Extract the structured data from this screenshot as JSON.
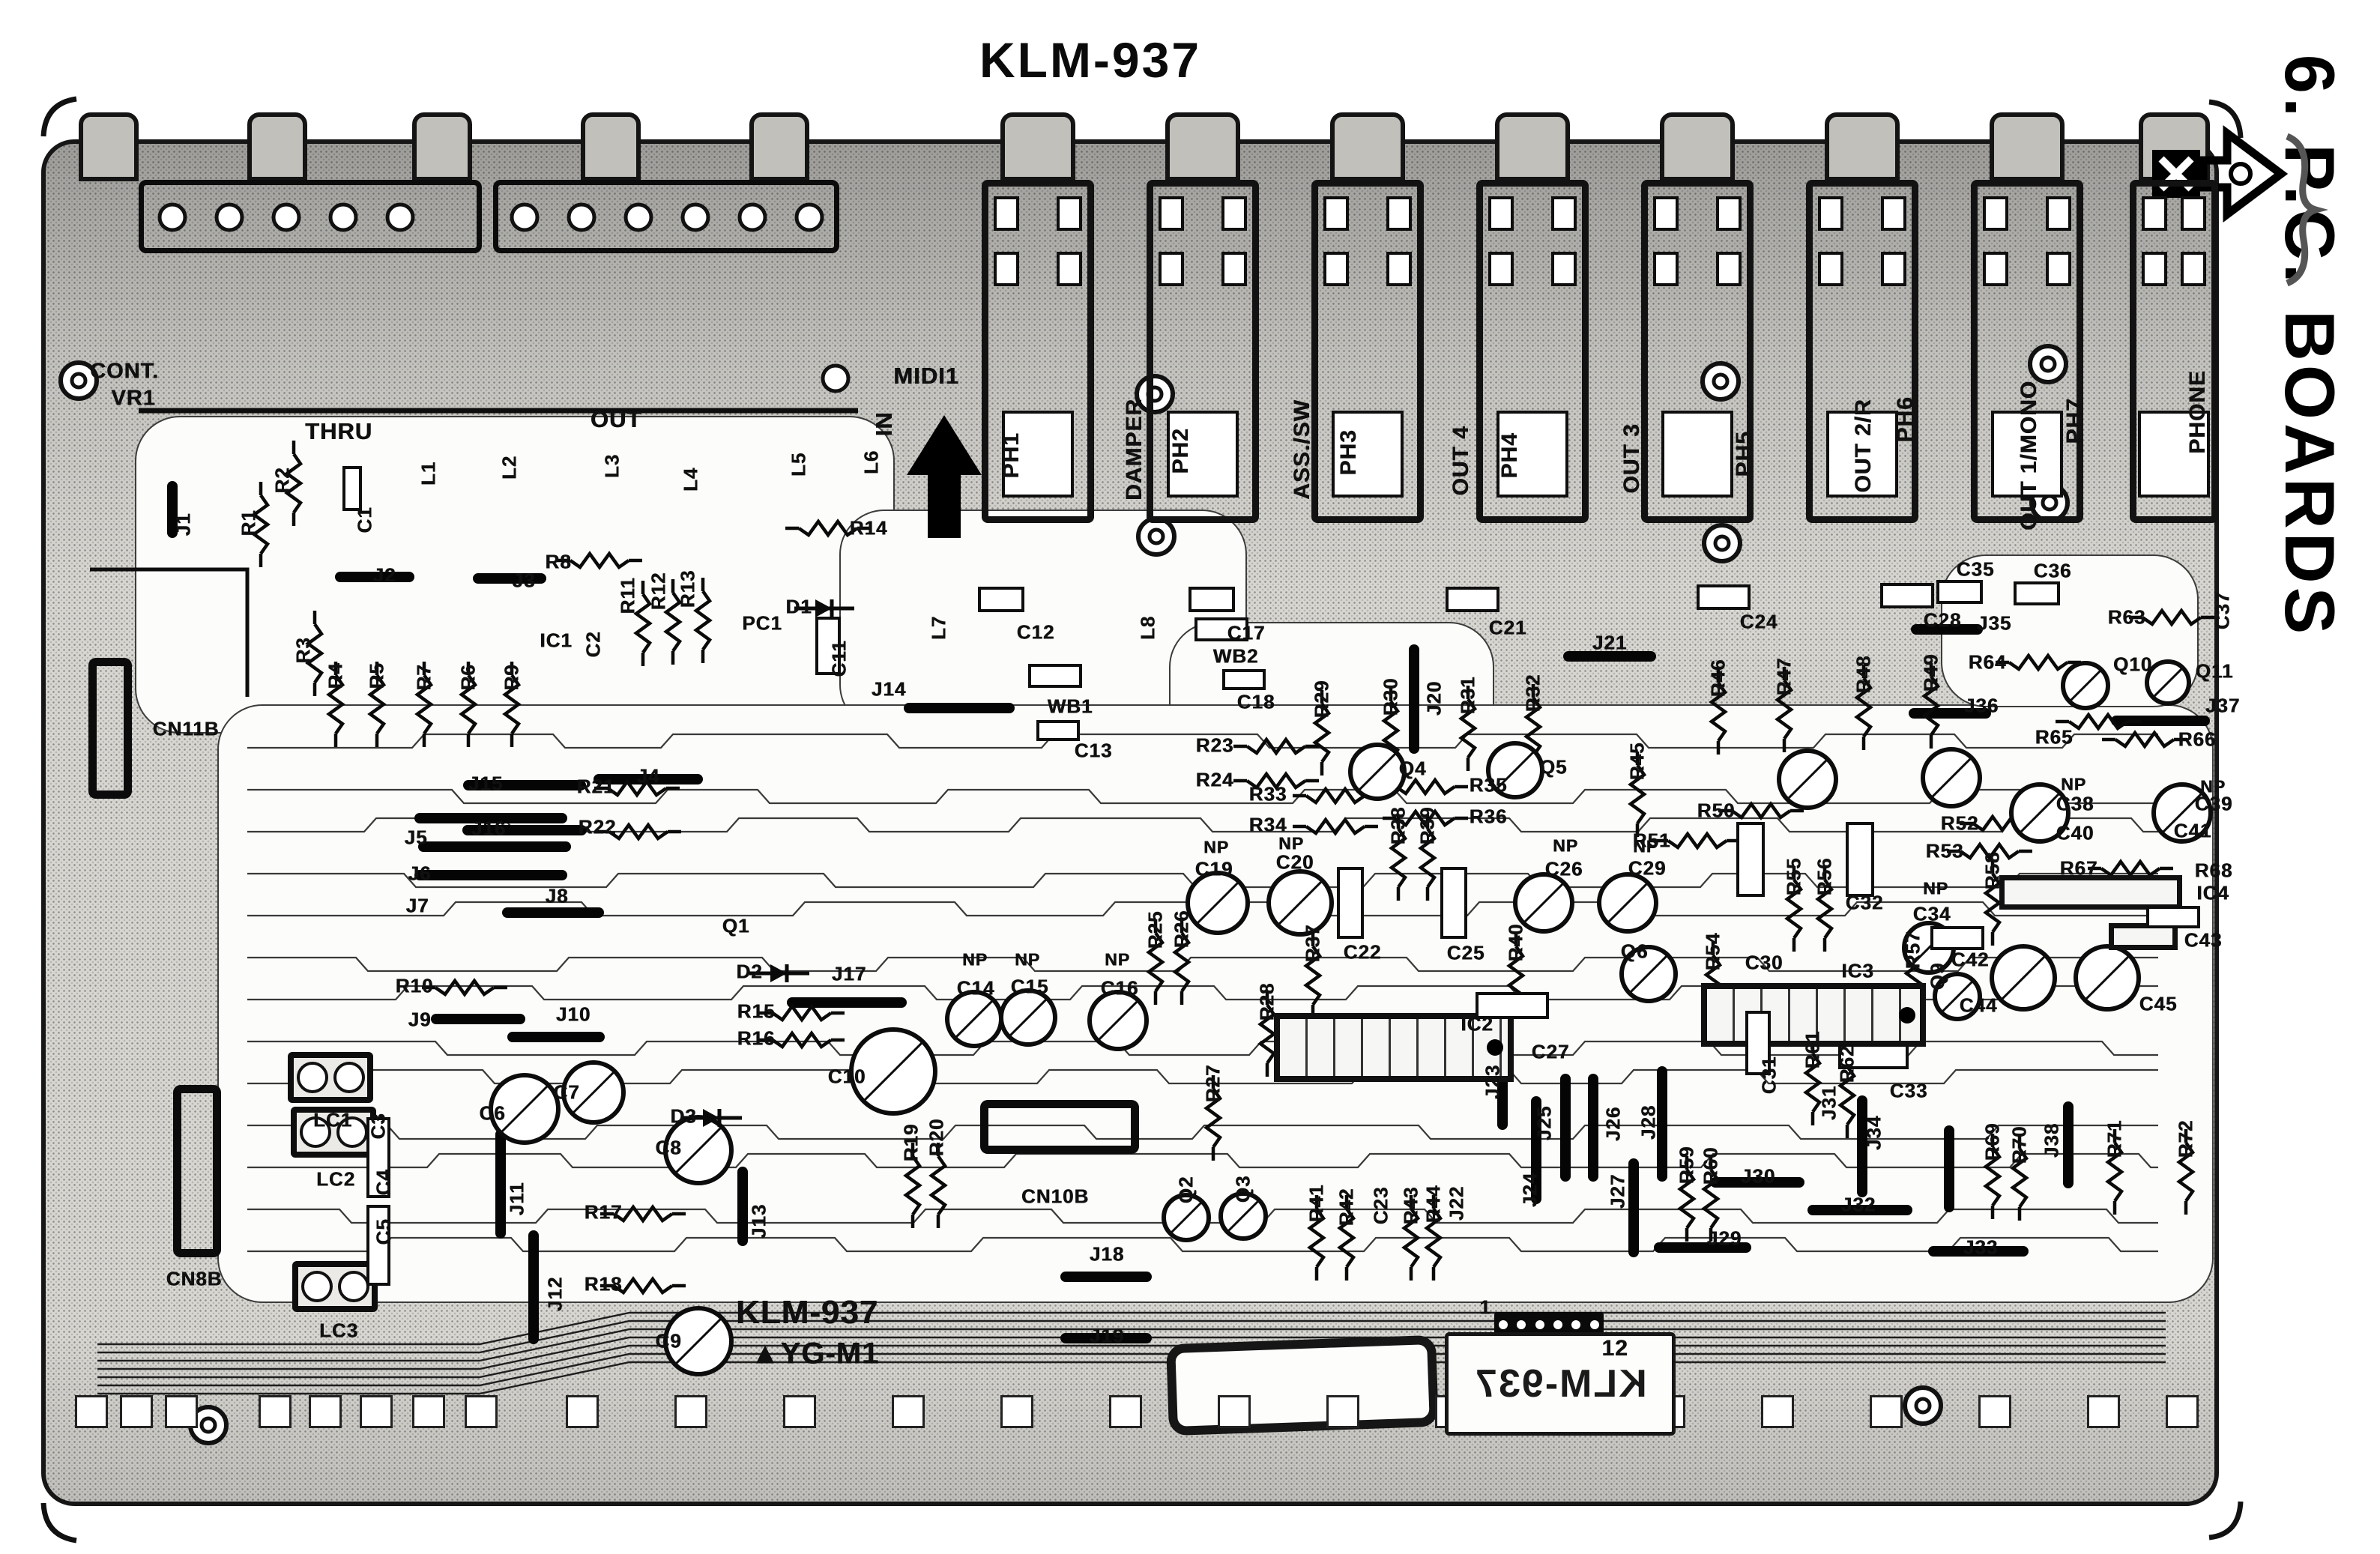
{
  "page": {
    "title": "KLM-937",
    "section": "6. P.C. BOARDS"
  },
  "board": {
    "name": "KLM-937",
    "silk_title": "KLM-937",
    "silk_marking": "YG-M1",
    "silk_title_mirrored": "KLM-937",
    "connector_pin_first": "1",
    "connector_pin_last": "12",
    "labels": [
      [
        "CONT.",
        166,
        496,
        0,
        29
      ],
      [
        "VR1",
        178,
        532,
        0,
        29
      ],
      [
        "THRU",
        452,
        576,
        0,
        31
      ],
      [
        "OUT",
        822,
        560,
        0,
        31
      ],
      [
        "MIDI1",
        1236,
        502,
        0,
        31
      ],
      [
        "IN",
        1180,
        566,
        1,
        31
      ],
      [
        "L1",
        572,
        632,
        1
      ],
      [
        "L2",
        680,
        624,
        1
      ],
      [
        "L3",
        817,
        622,
        1
      ],
      [
        "L4",
        922,
        640,
        1
      ],
      [
        "L5",
        1066,
        620,
        1
      ],
      [
        "L6",
        1163,
        617,
        1
      ],
      [
        "L7",
        1253,
        838,
        1
      ],
      [
        "L8",
        1532,
        838,
        1
      ],
      [
        "J1",
        245,
        700,
        1
      ],
      [
        "R1",
        332,
        698,
        1
      ],
      [
        "R2",
        377,
        641,
        1
      ],
      [
        "C1",
        487,
        694,
        1
      ],
      [
        "R3",
        405,
        868,
        1
      ],
      [
        "J2",
        513,
        768,
        0
      ],
      [
        "J3",
        699,
        775,
        0
      ],
      [
        "R8",
        745,
        750,
        0
      ],
      [
        "R11",
        838,
        795,
        1
      ],
      [
        "R12",
        879,
        789,
        1
      ],
      [
        "R13",
        918,
        786,
        1
      ],
      [
        "IC1",
        742,
        855,
        0
      ],
      [
        "C2",
        792,
        860,
        1
      ],
      [
        "PC1",
        1017,
        832,
        0
      ],
      [
        "D1",
        1066,
        810,
        0
      ],
      [
        "R14",
        1159,
        705,
        0
      ],
      [
        "C11",
        1120,
        879,
        1
      ],
      [
        "J14",
        1186,
        920,
        0
      ],
      [
        "R4",
        448,
        902,
        1
      ],
      [
        "R5",
        503,
        902,
        1
      ],
      [
        "R7",
        566,
        904,
        1
      ],
      [
        "R6",
        625,
        904,
        1
      ],
      [
        "R9",
        683,
        904,
        1
      ],
      [
        "J4",
        865,
        1036,
        0
      ],
      [
        "J15",
        648,
        1046,
        0
      ],
      [
        "R21",
        795,
        1050,
        0
      ],
      [
        "J16",
        652,
        1106,
        0
      ],
      [
        "R22",
        797,
        1104,
        0
      ],
      [
        "C12",
        1382,
        844,
        0
      ],
      [
        "WB1",
        1428,
        943,
        0
      ],
      [
        "C13",
        1459,
        1002,
        0
      ],
      [
        "WB2",
        1649,
        876,
        0
      ],
      [
        "C18",
        1676,
        937,
        0
      ],
      [
        "C17",
        1663,
        845,
        0
      ],
      [
        "R23",
        1621,
        995,
        0
      ],
      [
        "R24",
        1621,
        1041,
        0
      ],
      [
        "PH1",
        1350,
        608,
        1,
        30
      ],
      [
        "DAMPER",
        1514,
        600,
        1,
        30
      ],
      [
        "PH2",
        1576,
        602,
        1,
        30
      ],
      [
        "ASS./SW",
        1738,
        600,
        1,
        30
      ],
      [
        "PH3",
        1800,
        604,
        1,
        30
      ],
      [
        "OUT 4",
        1950,
        615,
        1,
        30
      ],
      [
        "PH4",
        2015,
        608,
        1,
        30
      ],
      [
        "OUT 3",
        2178,
        612,
        1,
        30
      ],
      [
        "PH5",
        2328,
        606,
        1,
        30
      ],
      [
        "OUT 2/R",
        2487,
        595,
        1,
        30
      ],
      [
        "PH6",
        2543,
        560,
        1,
        30
      ],
      [
        "OUT 1/MONO",
        2708,
        608,
        1,
        30
      ],
      [
        "PH7",
        2769,
        562,
        1,
        30
      ],
      [
        "PHONE",
        2933,
        550,
        1,
        30
      ],
      [
        "C37",
        2966,
        815,
        1
      ],
      [
        "C21",
        2012,
        838,
        0
      ],
      [
        "J21",
        2148,
        858,
        0
      ],
      [
        "C24",
        2347,
        830,
        0
      ],
      [
        "C28",
        2592,
        828,
        0
      ],
      [
        "C35",
        2636,
        760,
        0
      ],
      [
        "C36",
        2739,
        762,
        0
      ],
      [
        "J35",
        2661,
        832,
        0
      ],
      [
        "R63",
        2838,
        824,
        0
      ],
      [
        "R64",
        2652,
        884,
        0
      ],
      [
        "Q10",
        2846,
        887,
        0
      ],
      [
        "Q11",
        2955,
        896,
        0
      ],
      [
        "J36",
        2644,
        942,
        0
      ],
      [
        "J37",
        2966,
        942,
        0
      ],
      [
        "R65",
        2741,
        984,
        0
      ],
      [
        "R66",
        2932,
        987,
        0
      ],
      [
        "R29",
        1764,
        933,
        1
      ],
      [
        "R30",
        1856,
        930,
        1
      ],
      [
        "J20",
        1914,
        932,
        1
      ],
      [
        "R31",
        1959,
        928,
        1
      ],
      [
        "R32",
        2046,
        925,
        1
      ],
      [
        "Q4",
        1885,
        1026,
        0
      ],
      [
        "Q5",
        2073,
        1024,
        0
      ],
      [
        "R45",
        2185,
        1016,
        1
      ],
      [
        "R46",
        2293,
        905,
        1
      ],
      [
        "R47",
        2381,
        903,
        1
      ],
      [
        "R48",
        2487,
        900,
        1
      ],
      [
        "R49",
        2577,
        898,
        1
      ],
      [
        "R33",
        1692,
        1060,
        0
      ],
      [
        "R34",
        1692,
        1101,
        0
      ],
      [
        "R35",
        1986,
        1048,
        0
      ],
      [
        "R36",
        1986,
        1090,
        0
      ],
      [
        "R38",
        1866,
        1102,
        1
      ],
      [
        "R39",
        1905,
        1102,
        1
      ],
      [
        "NP",
        1623,
        1131,
        0,
        23
      ],
      [
        "C19",
        1620,
        1160,
        0
      ],
      [
        "NP",
        1723,
        1126,
        0,
        23
      ],
      [
        "C20",
        1728,
        1151,
        0
      ],
      [
        "R37",
        1752,
        1259,
        1
      ],
      [
        "C22",
        1818,
        1271,
        0
      ],
      [
        "C25",
        1956,
        1272,
        0
      ],
      [
        "R40",
        2023,
        1258,
        1
      ],
      [
        "R25",
        1542,
        1241,
        1
      ],
      [
        "R26",
        1577,
        1240,
        1
      ],
      [
        "R27",
        1619,
        1446,
        1
      ],
      [
        "R28",
        1691,
        1337,
        1
      ],
      [
        "IC2",
        1971,
        1367,
        0
      ],
      [
        "J23",
        1992,
        1444,
        1
      ],
      [
        "C27",
        2069,
        1404,
        0
      ],
      [
        "NP",
        2089,
        1129,
        0,
        23
      ],
      [
        "C26",
        2087,
        1160,
        0
      ],
      [
        "NP",
        2196,
        1130,
        0,
        23
      ],
      [
        "C29",
        2198,
        1159,
        0
      ],
      [
        "Q6",
        2181,
        1270,
        0
      ],
      [
        "R54",
        2286,
        1270,
        1
      ],
      [
        "C30",
        2354,
        1285,
        0
      ],
      [
        "IC3",
        2479,
        1296,
        0
      ],
      [
        "R57",
        2553,
        1268,
        1
      ],
      [
        "Q9",
        2586,
        1303,
        1
      ],
      [
        "C42",
        2629,
        1281,
        0
      ],
      [
        "R50",
        2290,
        1082,
        0
      ],
      [
        "R51",
        2204,
        1122,
        0
      ],
      [
        "R55",
        2394,
        1170,
        1
      ],
      [
        "R56",
        2435,
        1170,
        1
      ],
      [
        "C32",
        2488,
        1205,
        0
      ],
      [
        "NP",
        2583,
        1186,
        0,
        23
      ],
      [
        "C34",
        2578,
        1220,
        0
      ],
      [
        "R52",
        2615,
        1099,
        0
      ],
      [
        "R53",
        2595,
        1136,
        0
      ],
      [
        "R58",
        2659,
        1162,
        1
      ],
      [
        "NP",
        2767,
        1047,
        0,
        23
      ],
      [
        "C38",
        2769,
        1073,
        0
      ],
      [
        "NP",
        2953,
        1050,
        0,
        23
      ],
      [
        "C39",
        2954,
        1073,
        0
      ],
      [
        "C40",
        2769,
        1112,
        0
      ],
      [
        "C41",
        2926,
        1109,
        0
      ],
      [
        "R67",
        2774,
        1159,
        0
      ],
      [
        "R68",
        2954,
        1162,
        0
      ],
      [
        "IC4",
        2953,
        1192,
        0
      ],
      [
        "C43",
        2940,
        1255,
        0
      ],
      [
        "C44",
        2640,
        1342,
        0
      ],
      [
        "C45",
        2880,
        1340,
        0
      ],
      [
        "CN11B",
        248,
        973,
        0
      ],
      [
        "J5",
        555,
        1118,
        0
      ],
      [
        "J6",
        560,
        1166,
        0
      ],
      [
        "J7",
        557,
        1209,
        0
      ],
      [
        "J8",
        743,
        1196,
        0
      ],
      [
        "R10",
        553,
        1316,
        0
      ],
      [
        "J9",
        560,
        1361,
        0
      ],
      [
        "J10",
        765,
        1354,
        0
      ],
      [
        "Q1",
        982,
        1236,
        0
      ],
      [
        "D2",
        1000,
        1297,
        0
      ],
      [
        "J17",
        1133,
        1300,
        0
      ],
      [
        "R15",
        1009,
        1350,
        0
      ],
      [
        "R16",
        1009,
        1386,
        0
      ],
      [
        "C7",
        756,
        1458,
        0
      ],
      [
        "D3",
        912,
        1490,
        0
      ],
      [
        "C10",
        1130,
        1437,
        0
      ],
      [
        "C6",
        657,
        1486,
        0
      ],
      [
        "LC1",
        444,
        1495,
        0
      ],
      [
        "C3",
        505,
        1503,
        1
      ],
      [
        "C8",
        892,
        1532,
        0
      ],
      [
        "R17",
        805,
        1618,
        0
      ],
      [
        "R18",
        805,
        1714,
        0
      ],
      [
        "C9",
        892,
        1790,
        0
      ],
      [
        "J11",
        690,
        1600,
        1
      ],
      [
        "J13",
        1013,
        1630,
        1
      ],
      [
        "R19",
        1216,
        1525,
        1
      ],
      [
        "R20",
        1250,
        1518,
        1
      ],
      [
        "LC2",
        448,
        1574,
        0
      ],
      [
        "C4",
        512,
        1578,
        1
      ],
      [
        "C5",
        512,
        1644,
        1
      ],
      [
        "CN8B",
        259,
        1707,
        0
      ],
      [
        "LC3",
        452,
        1776,
        0
      ],
      [
        "J12",
        741,
        1727,
        1
      ],
      [
        "NP",
        1301,
        1281,
        0,
        23
      ],
      [
        "C14",
        1302,
        1319,
        0
      ],
      [
        "NP",
        1371,
        1281,
        0,
        23
      ],
      [
        "C15",
        1374,
        1317,
        0
      ],
      [
        "NP",
        1491,
        1281,
        0,
        23
      ],
      [
        "C16",
        1494,
        1319,
        0
      ],
      [
        "CN10B",
        1408,
        1597,
        0
      ],
      [
        "Q2",
        1583,
        1588,
        1
      ],
      [
        "Q3",
        1659,
        1587,
        1
      ],
      [
        "J18",
        1477,
        1674,
        0
      ],
      [
        "J19",
        1477,
        1783,
        0
      ],
      [
        "R41",
        1757,
        1606,
        1
      ],
      [
        "R42",
        1797,
        1611,
        1
      ],
      [
        "C23",
        1843,
        1609,
        1
      ],
      [
        "R43",
        1883,
        1609,
        1
      ],
      [
        "R44",
        1913,
        1607,
        1
      ],
      [
        "J22",
        1944,
        1606,
        1
      ],
      [
        "J24",
        2042,
        1588,
        1
      ],
      [
        "J25",
        2061,
        1499,
        1
      ],
      [
        "J26",
        2153,
        1500,
        1
      ],
      [
        "J28",
        2200,
        1498,
        1
      ],
      [
        "J27",
        2159,
        1590,
        1
      ],
      [
        "R59",
        2251,
        1555,
        1
      ],
      [
        "R60",
        2283,
        1556,
        1
      ],
      [
        "J30",
        2346,
        1570,
        0
      ],
      [
        "J31",
        2441,
        1472,
        1
      ],
      [
        "J34",
        2501,
        1512,
        1
      ],
      [
        "J32",
        2480,
        1608,
        0
      ],
      [
        "J33",
        2643,
        1665,
        0
      ],
      [
        "J29",
        2301,
        1653,
        0
      ],
      [
        "C31",
        2361,
        1435,
        1
      ],
      [
        "R61",
        2419,
        1401,
        1
      ],
      [
        "R62",
        2465,
        1420,
        1
      ],
      [
        "C33",
        2547,
        1456,
        0
      ],
      [
        "R71",
        2822,
        1520,
        1
      ],
      [
        "R72",
        2917,
        1520,
        1
      ],
      [
        "J38",
        2738,
        1522,
        1
      ],
      [
        "R70",
        2695,
        1528,
        1
      ],
      [
        "R69",
        2659,
        1524,
        1
      ],
      [
        "KLM-937",
        1077,
        1752,
        0,
        44
      ],
      [
        "▲YG-M1",
        1087,
        1807,
        0,
        40
      ],
      [
        "1",
        1982,
        1745,
        0,
        26
      ],
      [
        "12",
        2155,
        1800,
        0,
        30
      ]
    ]
  }
}
